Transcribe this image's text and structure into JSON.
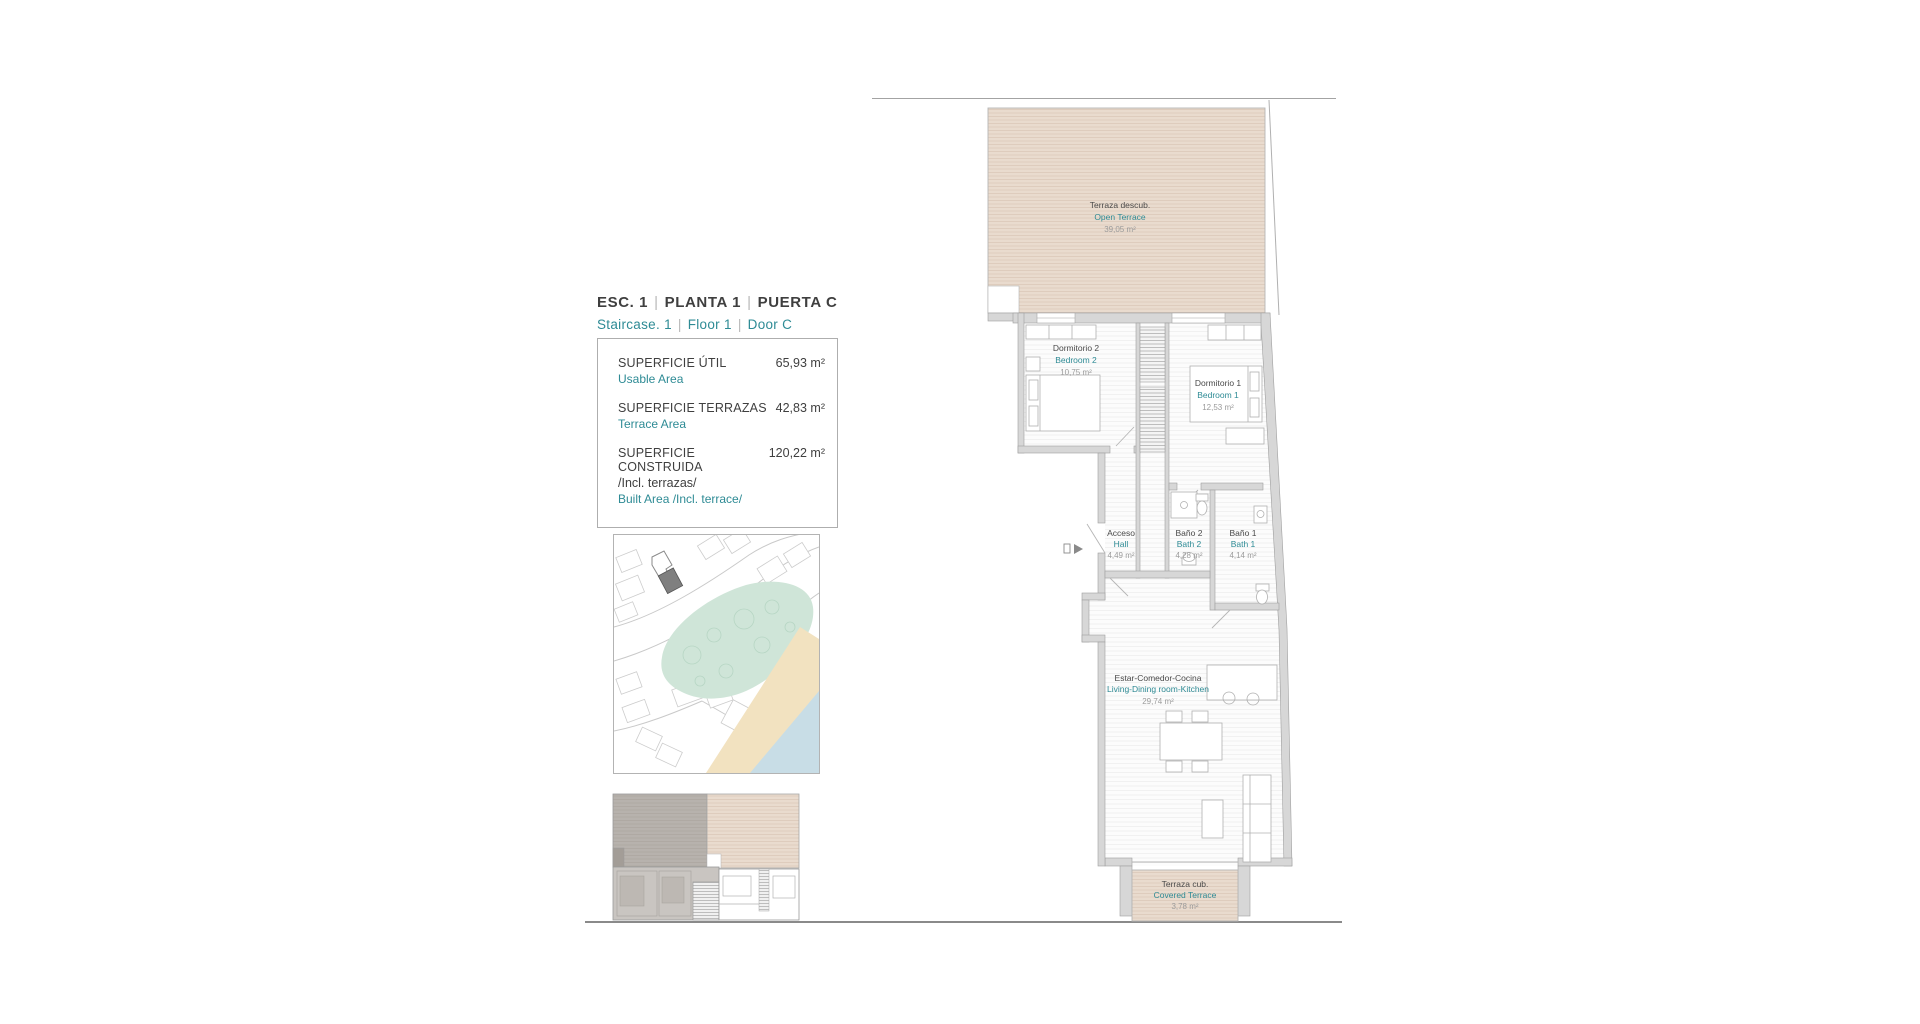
{
  "colors": {
    "accent_teal": "#2e8b95",
    "text_dark": "#3f3f3f",
    "area_gray": "#9b9b9b",
    "terrace_fill": "#e9dbce",
    "terrace_hatch": "#dcc9b9",
    "wall_fill": "#d7d7d7",
    "wall_edge": "#9f9f9f",
    "map_park": "#cfe5d8",
    "map_sand": "#f2e2c0",
    "map_sea": "#c8dde6",
    "map_highlight_building": "#7f7f7f"
  },
  "plan_ref": {
    "separator": "|",
    "es_parts": [
      "ESC. 1",
      "PLANTA 1",
      "PUERTA C"
    ],
    "en_parts": [
      "Staircase. 1",
      "Floor 1",
      "Door C"
    ]
  },
  "areas": {
    "rows": [
      {
        "label_es": "SUPERFICIE ÚTIL",
        "label_en": "Usable Area",
        "value": "65,93 m²"
      },
      {
        "label_es": "SUPERFICIE TERRAZAS",
        "label_en": "Terrace Area",
        "value": "42,83 m²"
      },
      {
        "label_es": "SUPERFICIE CONSTRUIDA",
        "note_es": "/Incl. terrazas/",
        "label_en": "Built Area /Incl. terrace/",
        "value": "120,22 m²"
      }
    ]
  },
  "plan": {
    "rooms": [
      {
        "name_es": "Terraza descub.",
        "name_en": "Open Terrace",
        "area": "39,05 m²"
      },
      {
        "name_es": "Dormitorio 2",
        "name_en": "Bedroom 2",
        "area": "10,75 m²"
      },
      {
        "name_es": "Dormitorio 1",
        "name_en": "Bedroom 1",
        "area": "12,53 m²"
      },
      {
        "name_es": "Acceso",
        "name_en": "Hall",
        "area": "4,49 m²"
      },
      {
        "name_es": "Baño 2",
        "name_en": "Bath 2",
        "area": "4,28 m²"
      },
      {
        "name_es": "Baño 1",
        "name_en": "Bath 1",
        "area": "4,14 m²"
      },
      {
        "name_es": "Estar-Comedor-Cocina",
        "name_en": "Living-Dining room-Kitchen",
        "area": "29,74 m²"
      },
      {
        "name_es": "Terraza cub.",
        "name_en": "Covered Terrace",
        "area": "3,78 m²"
      }
    ]
  }
}
